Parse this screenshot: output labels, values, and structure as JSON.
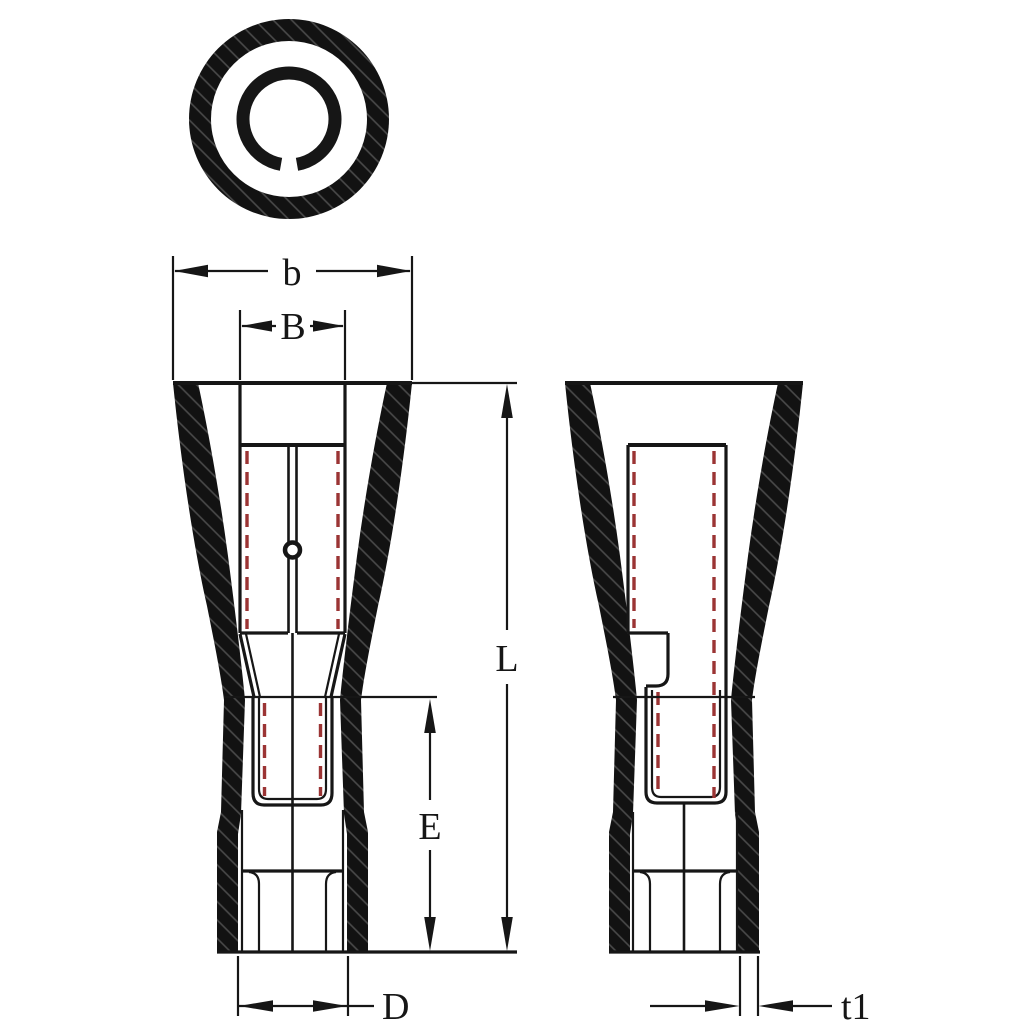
{
  "drawing": {
    "kind": "technical-drawing",
    "subject": "insulated female bullet terminal, two side views and end view",
    "colors": {
      "line": "#161616",
      "hidden_line": "#9b3434",
      "background": "#ffffff"
    },
    "dimensions": {
      "b": {
        "label": "b",
        "measures": "outer width at top of insulation"
      },
      "B": {
        "label": "B",
        "measures": "inner receptacle width"
      },
      "L": {
        "label": "L",
        "measures": "overall length"
      },
      "E": {
        "label": "E",
        "measures": "lower sleeve length"
      },
      "D": {
        "label": "D",
        "measures": "bottom barrel diameter"
      },
      "t1": {
        "label": "t1",
        "measures": "wall thickness"
      }
    }
  }
}
